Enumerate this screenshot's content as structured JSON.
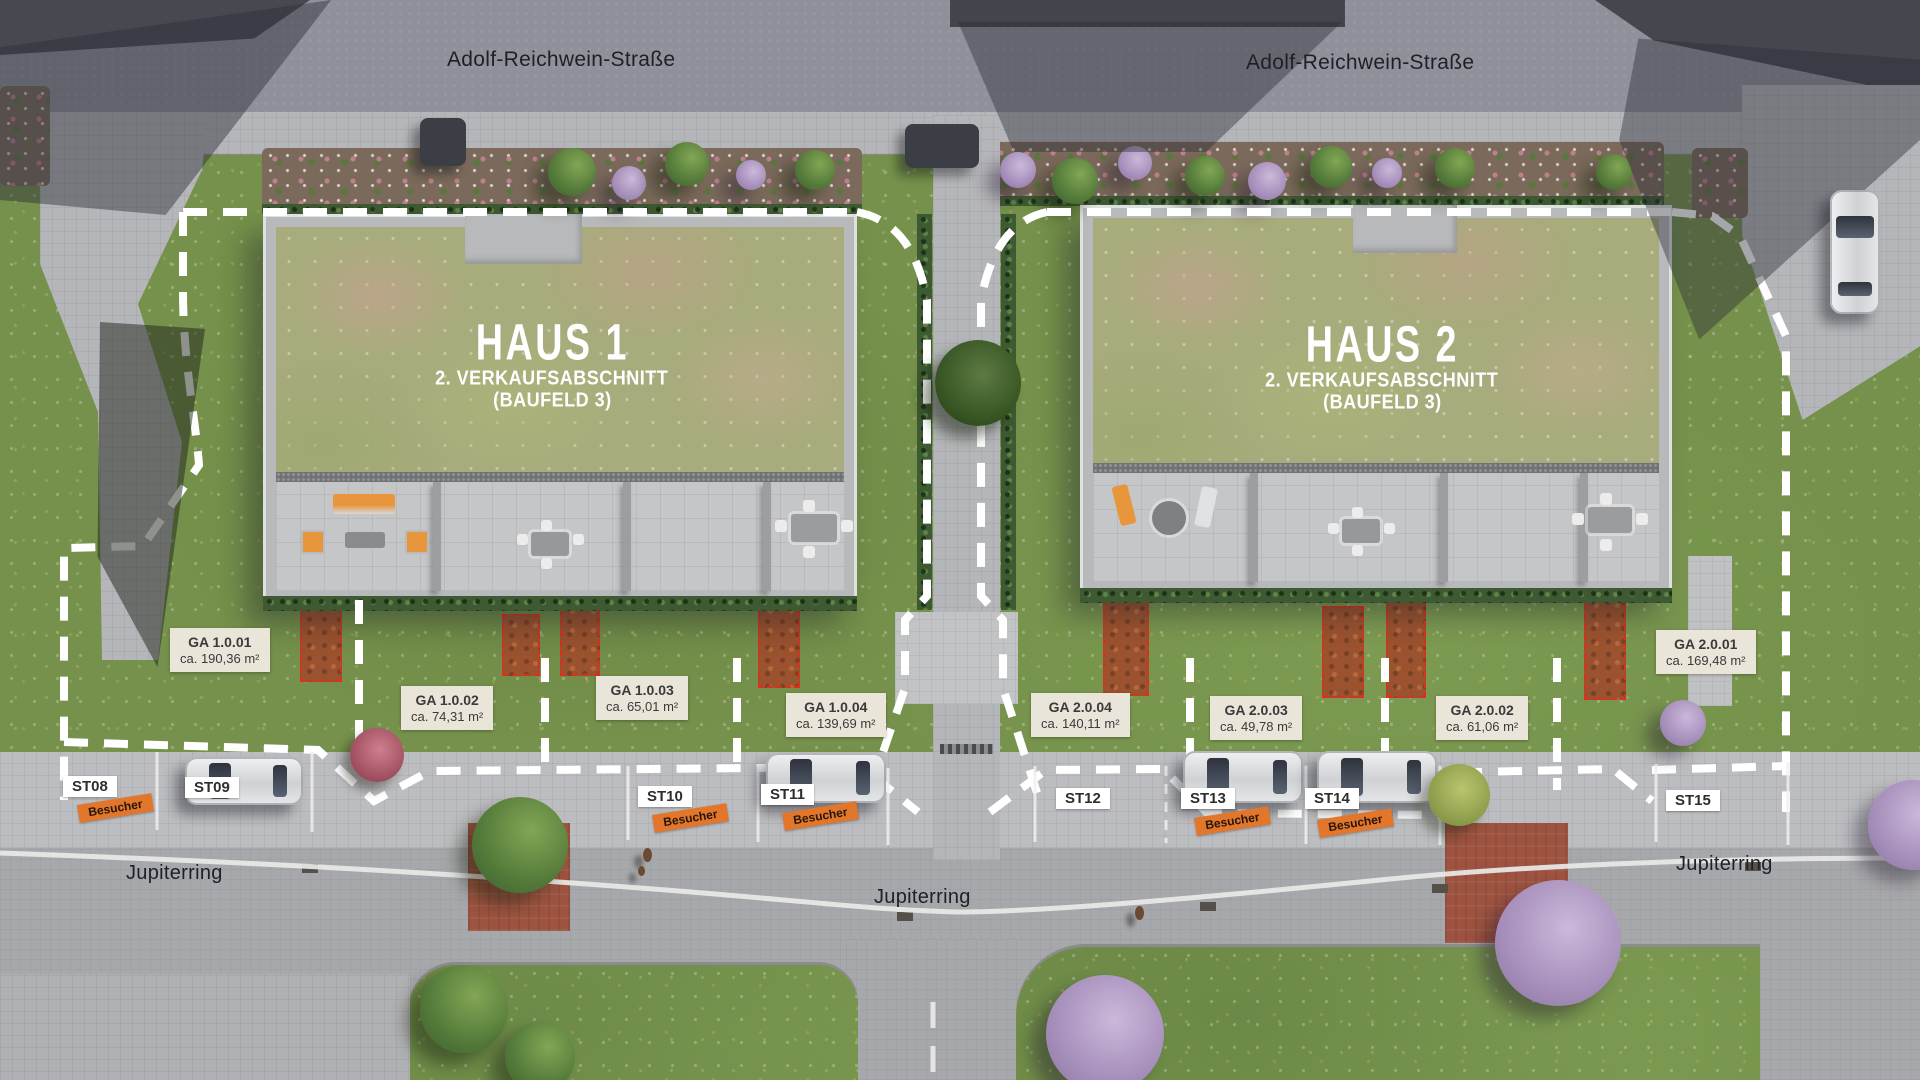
{
  "streets": {
    "adolf_reichwein": "Adolf-Reichwein-Straße",
    "jupiterring": "Jupiterring"
  },
  "houses": [
    {
      "name": "HAUS 1",
      "subtitle": "2. VERKAUFSABSCHNITT",
      "subtitle2": "(BAUFELD 3)"
    },
    {
      "name": "HAUS 2",
      "subtitle": "2. VERKAUFSABSCHNITT",
      "subtitle2": "(BAUFELD 3)"
    }
  ],
  "garden_areas": [
    {
      "id": "GA 1.0.01",
      "area": "ca. 190,36 m²"
    },
    {
      "id": "GA 1.0.02",
      "area": "ca. 74,31 m²"
    },
    {
      "id": "GA 1.0.03",
      "area": "ca. 65,01 m²"
    },
    {
      "id": "GA 1.0.04",
      "area": "ca. 139,69 m²"
    },
    {
      "id": "GA 2.0.04",
      "area": "ca. 140,11 m²"
    },
    {
      "id": "GA 2.0.03",
      "area": "ca. 49,78 m²"
    },
    {
      "id": "GA 2.0.02",
      "area": "ca. 61,06 m²"
    },
    {
      "id": "GA 2.0.01",
      "area": "ca. 169,48 m²"
    }
  ],
  "parking_spots": [
    {
      "id": "ST08",
      "tag": "Besucher"
    },
    {
      "id": "ST09"
    },
    {
      "id": "ST10",
      "tag": "Besucher"
    },
    {
      "id": "ST11",
      "tag": "Besucher"
    },
    {
      "id": "ST12"
    },
    {
      "id": "ST13",
      "tag": "Besucher"
    },
    {
      "id": "ST14",
      "tag": "Besucher"
    },
    {
      "id": "ST15"
    }
  ],
  "colors": {
    "visitor_tag": "#e2762b",
    "area_label_bg": "#e9e5d9",
    "boundary": "#ffffff",
    "planting_bed": "#9a522f"
  }
}
